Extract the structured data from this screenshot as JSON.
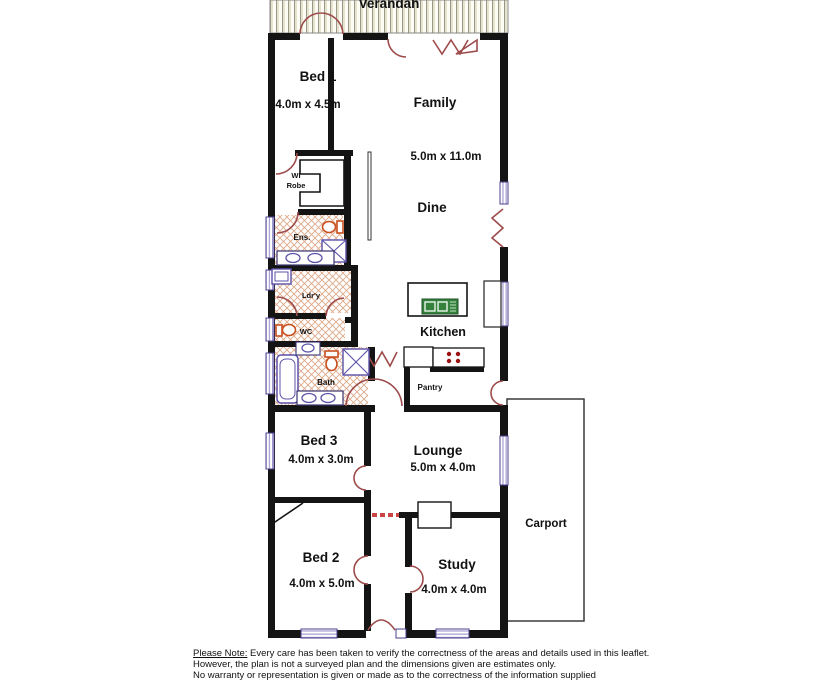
{
  "plan": {
    "verandah_label": "Verandah",
    "rooms": {
      "bed1": {
        "name": "Bed 1",
        "dims": "4.0m x 4.5m"
      },
      "family": {
        "name": "Family",
        "dims": "5.0m x 11.0m"
      },
      "dine": {
        "name": "Dine"
      },
      "wirobe": {
        "line1": "WI",
        "line2": "Robe"
      },
      "ens": {
        "name": "Ens."
      },
      "ldry": {
        "name": "Ldr'y"
      },
      "wc": {
        "name": "WC"
      },
      "bath": {
        "name": "Bath"
      },
      "kitchen": {
        "name": "Kitchen"
      },
      "pantry": {
        "name": "Pantry"
      },
      "bed3": {
        "name": "Bed 3",
        "dims": "4.0m x 3.0m"
      },
      "lounge": {
        "name": "Lounge",
        "dims": "5.0m x 4.0m"
      },
      "bed2": {
        "name": "Bed 2",
        "dims": "4.0m x 5.0m"
      },
      "study": {
        "name": "Study",
        "dims": "4.0m x 4.0m"
      },
      "carport": {
        "name": "Carport"
      }
    },
    "colors": {
      "wall": "#141414",
      "door_arc": "#9d4b4b",
      "window_frame": "#4a4190",
      "window_stripe": "#9a92cc",
      "floor_hatch": "#d08a5f",
      "fixture": "#5b51a8",
      "toilet": "#c8501e",
      "sink_green": "#37813f",
      "cooktop_dot": "#991111"
    }
  },
  "disclaimer": {
    "label": "Please Note:",
    "line1": "  Every care has been taken to verify the correctness of the areas and details used in this leaflet.",
    "line2": "However, the plan is not a surveyed plan and the dimensions given are estimates only.",
    "line3": "No warranty or representation is given or made as to the correctness of the information supplied"
  }
}
